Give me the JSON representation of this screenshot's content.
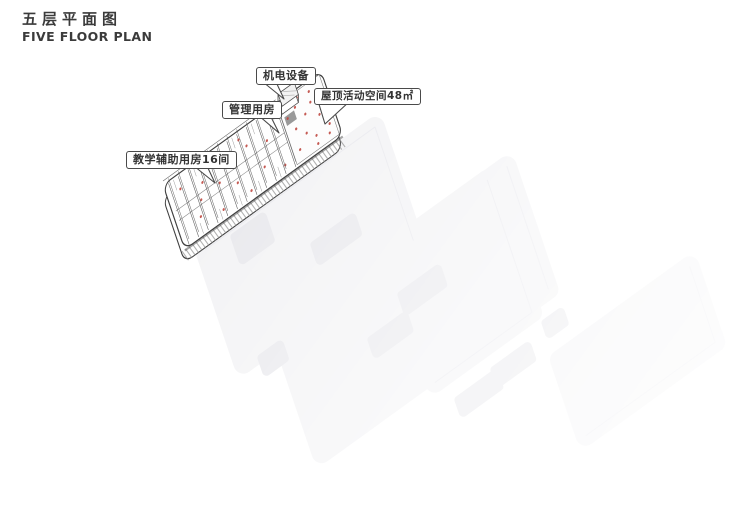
{
  "header": {
    "title_cn": "五层平面图",
    "title_en": "FIVE FLOOR PLAN"
  },
  "diagram": {
    "labels": [
      {
        "id": "mech-equipment",
        "text": "机电设备"
      },
      {
        "id": "management-room",
        "text": "管理用房"
      },
      {
        "id": "roof-activity-space",
        "text": "屋顶活动空间48㎡"
      },
      {
        "id": "teaching-aux-rooms",
        "text": "教学辅助用房16间"
      }
    ],
    "colors": {
      "line_dark": "#3f3f3f",
      "line_mid": "#6f6f6f",
      "marker_red": "#bf4a42",
      "ghost_base": "#f3f3f5",
      "ghost_hole": "#e9e9ed",
      "label_border": "#4a4a4a",
      "label_text": "#333333"
    }
  }
}
